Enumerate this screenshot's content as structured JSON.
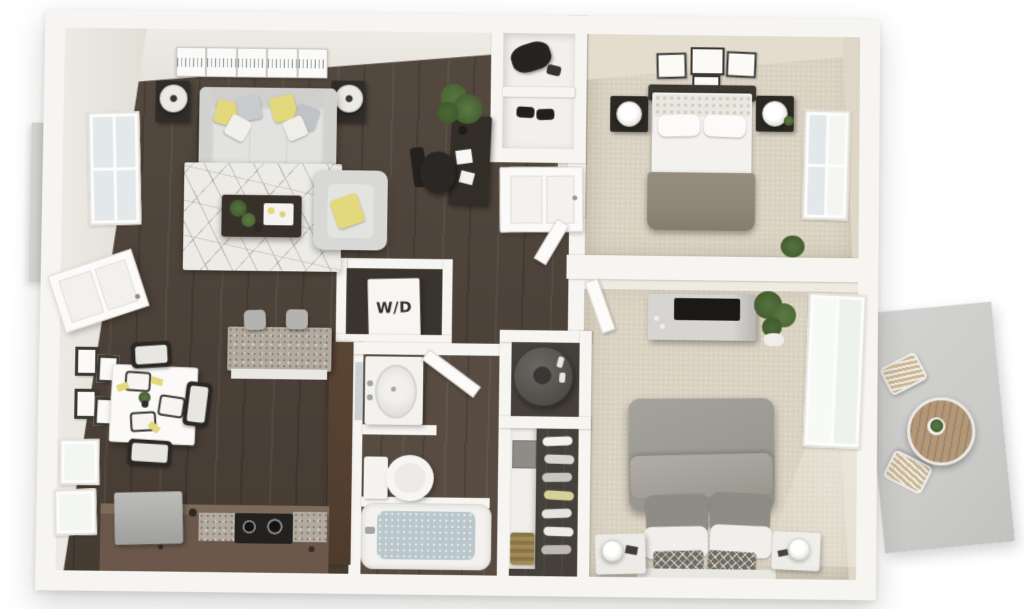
{
  "page": {
    "background": "#ffffff",
    "description": "3D top-down rendered floor plan of a two-bedroom apartment"
  },
  "floorplan": {
    "view": "3d-top-down-render",
    "labels": {
      "washer_dryer": "W/D"
    },
    "colors": {
      "background": "#ffffff",
      "wall": "#f7f5f1",
      "wall_edge": "#d8d4cc",
      "wall_face": "#e8e5de",
      "wall_face_tan": "#ded6c6",
      "wood": "#4d4238",
      "carpet": "#d9d1c0",
      "bath_floor": "#584c42",
      "closet_floor": "#46403a",
      "cabinet": "#6b584a",
      "pantry": "#4f3b2c",
      "granite": "#b2aa9e",
      "fridge": "#aaaaa8",
      "sofa": "#d9d9d7",
      "cushion": "#e2e2e0",
      "rug": "#edebe6",
      "rug_line": "#96948c",
      "accent_yellow": "#e4d87d",
      "dark_furniture": "#332d27",
      "bed1_blanket": "#8e8679",
      "bed2_duvet": "#9c9993",
      "white_soft": "#f2f1ee",
      "water": "#bac7cc",
      "concrete": "#cbcbc9",
      "patio_wood": "#b29878",
      "plant": "#4e6b3a",
      "plant_dark": "#3c5429",
      "tv": "#1b1918",
      "steel": "#9fa3a5",
      "stool": "#b5b3b0",
      "heater": "#55534e",
      "basket": "#9a8454",
      "window_pane": "#e3e8ea"
    },
    "rooms": [
      {
        "id": "living-room",
        "floor": "dark-hardwood",
        "items": [
          "sofa",
          "throw-pillows",
          "area-rug",
          "coffee-table",
          "plants",
          "armchair",
          "end-tables",
          "table-lamps",
          "panoramic-wall-art",
          "desk",
          "office-chair",
          "tall-plant"
        ]
      },
      {
        "id": "dining-area",
        "floor": "dark-hardwood",
        "items": [
          "square-dining-table",
          "dining-chairs",
          "place-settings",
          "framed-wall-art",
          "windows"
        ]
      },
      {
        "id": "kitchen",
        "floor": "dark-hardwood",
        "items": [
          "granite-breakfast-bar",
          "bar-stools",
          "refrigerator",
          "cooktop",
          "granite-counters",
          "pantry-cabinet"
        ]
      },
      {
        "id": "entry",
        "items": [
          "front-door",
          "storage-shelves",
          "duffel-bag",
          "shoes"
        ]
      },
      {
        "id": "laundry-closet",
        "label": "W/D",
        "items": [
          "stacked-washer-dryer"
        ]
      },
      {
        "id": "bathroom",
        "floor": "dark-tile",
        "items": [
          "vanity-sink",
          "mirror",
          "toilet",
          "bathtub",
          "door"
        ]
      },
      {
        "id": "utility-closet",
        "items": [
          "water-heater"
        ]
      },
      {
        "id": "walk-in-closet",
        "items": [
          "hanging-clothes",
          "storage-box",
          "woven-hamper",
          "shelves"
        ]
      },
      {
        "id": "bedroom-1",
        "floor": "beige-carpet",
        "items": [
          "bed",
          "headboard",
          "pillows",
          "nightstands",
          "table-lamps",
          "gallery-wall-art",
          "window",
          "plant"
        ]
      },
      {
        "id": "bedroom-2",
        "floor": "beige-carpet",
        "items": [
          "bed",
          "pillows",
          "nightstands",
          "table-lamps",
          "media-console",
          "tv",
          "potted-plant",
          "window",
          "door"
        ]
      },
      {
        "id": "balcony-left",
        "items": [
          "concrete-slab",
          "balcony-door"
        ]
      },
      {
        "id": "patio",
        "floor": "concrete",
        "items": [
          "round-bistro-table",
          "patio-chairs",
          "centerpiece-plant"
        ]
      }
    ]
  }
}
